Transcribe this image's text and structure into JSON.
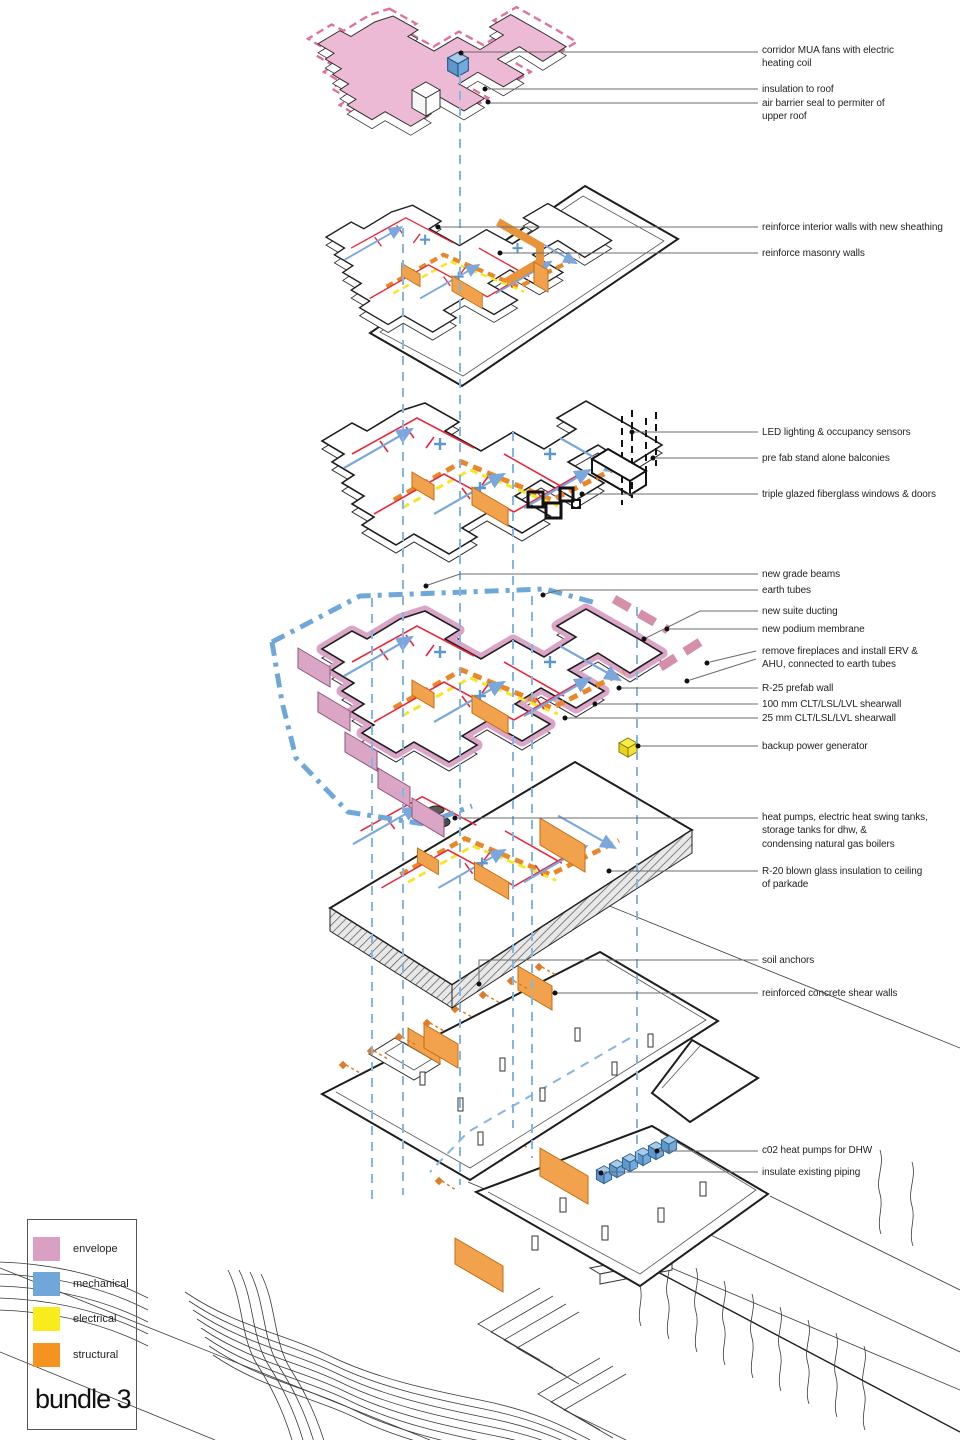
{
  "legend": {
    "title": "bundle 3",
    "items": [
      {
        "label": "envelope",
        "color": "#D9A0C4"
      },
      {
        "label": "mechanical",
        "color": "#6FA8D8"
      },
      {
        "label": "electrical",
        "color": "#F8EC1C"
      },
      {
        "label": "structural",
        "color": "#F6921E"
      }
    ]
  },
  "annotations": [
    {
      "text": "corridor MUA fans with electric\nheating coil"
    },
    {
      "text": "insulation to roof"
    },
    {
      "text": "air barrier seal to permiter of\nupper roof"
    },
    {
      "text": "reinforce interior walls with new sheathing"
    },
    {
      "text": "reinforce masonry walls"
    },
    {
      "text": "LED lighting & occupancy sensors"
    },
    {
      "text": "pre fab stand alone balconies"
    },
    {
      "text": "triple glazed fiberglass windows & doors"
    },
    {
      "text": "new grade beams"
    },
    {
      "text": "earth tubes"
    },
    {
      "text": "new suite ducting"
    },
    {
      "text": "new podium membrane"
    },
    {
      "text": "remove fireplaces and install ERV &\nAHU, connected to earth tubes"
    },
    {
      "text": "R-25 prefab wall"
    },
    {
      "text": "100 mm CLT/LSL/LVL shearwall"
    },
    {
      "text": "25 mm CLT/LSL/LVL shearwall"
    },
    {
      "text": "backup power generator"
    },
    {
      "text": "heat pumps, electric heat swing tanks,\nstorage tanks for dhw, &\ncondensing natural gas boilers"
    },
    {
      "text": "R-20 blown glass insulation to ceiling\nof parkade"
    },
    {
      "text": "soil anchors"
    },
    {
      "text": "reinforced concrete shear walls"
    },
    {
      "text": "c02 heat pumps for DHW"
    },
    {
      "text": "insulate existing piping"
    }
  ],
  "colors": {
    "envelope_fill": "#ECBAD4",
    "envelope_dash": "#E0719A",
    "mechanical_blue": "#6FA8D8",
    "riser_dash_blue": "#85B6E2",
    "electrical_yellow": "#F5E62A",
    "structural_orange": "#F6921E",
    "duct_orange": "#E8882B",
    "hydronic_red": "#E8273A",
    "line_black": "#1E1E1E",
    "leader_gray": "#6B6B6B"
  }
}
